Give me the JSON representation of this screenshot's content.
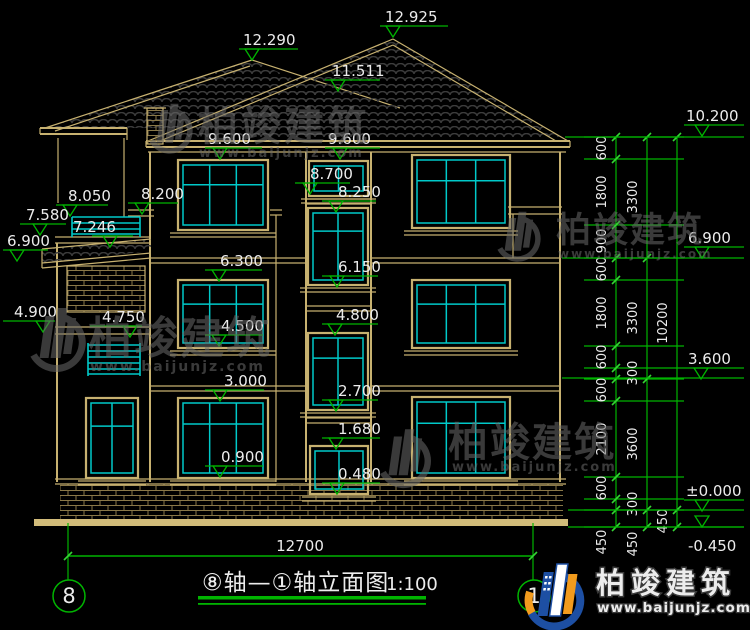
{
  "drawing": {
    "title": "⑧轴—①轴立面图",
    "scale": "1:100",
    "axis_left": "8",
    "axis_right": "1"
  },
  "levels": {
    "v12925": "12.925",
    "v12290": "12.290",
    "v11511": "11.511",
    "v9600a": "9.600",
    "v9600b": "9.600",
    "v8700": "8.700",
    "v8250": "8.250",
    "v8200": "8.200",
    "v8050": "8.050",
    "v7800": "7.800",
    "v7580": "7.580",
    "v7246": "7.246",
    "v6900L": "6.900",
    "v6300": "6.300",
    "v6150": "6.150",
    "v4900": "4.900",
    "v4800": "4.800",
    "v4750": "4.750",
    "v4500": "4.500",
    "v3000": "3.000",
    "v2700": "2.700",
    "v1680": "1.680",
    "v0900": "0.900",
    "v0480": "0.480",
    "v10200": "10.200",
    "v6900R": "6.900",
    "v3600": "3.600",
    "v0000": "±0.000",
    "vm0450": "-0.450"
  },
  "dims": {
    "col1": [
      "600",
      "1800",
      "900",
      "600",
      "1800",
      "600",
      "600",
      "2100",
      "600"
    ],
    "col1_small": [
      "300",
      "300"
    ],
    "col2": [
      "3300",
      "3300",
      "3600"
    ],
    "col3": [
      "10200"
    ],
    "bottom": [
      "450",
      "450",
      "450"
    ],
    "total_width": "12700"
  },
  "watermark": {
    "brand": "柏竣建筑",
    "site": "www.baijunjz.com"
  },
  "footer_logo": {
    "brand": "柏竣建筑",
    "site": "www.baijunjz.com"
  },
  "colors": {
    "line_tan": "#c7b170",
    "window_cyan": "#00c9c9",
    "dim_green": "#00b400",
    "text_white": "#ececec",
    "logo_blue": "#1d4fa3",
    "logo_orange": "#f29b1d"
  }
}
